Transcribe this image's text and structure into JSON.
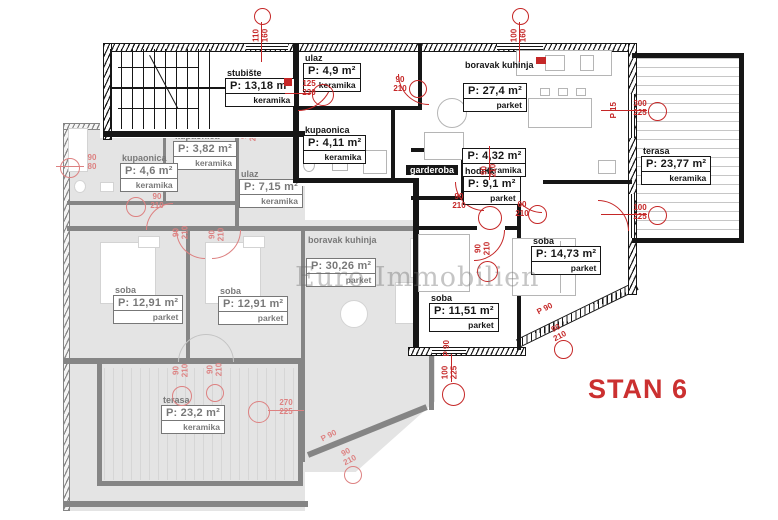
{
  "title": "STAN 6",
  "watermark": "Euro Immobilien",
  "colors": {
    "accent_red": "#c52727",
    "wall": "#161616",
    "faded_gray": "#e2e2e2"
  },
  "rooms": {
    "active": [
      {
        "n": "stubište",
        "a": "P: 13,18 m²",
        "f": "keramika"
      },
      {
        "n": "ulaz",
        "a": "P: 4,9 m²",
        "f": "keramika"
      },
      {
        "n": "kupaonica",
        "a": "P: 4,11 m²",
        "f": "keramika"
      },
      {
        "n": "boravak kuhinja",
        "a": "P: 27,4 m²",
        "f": "parket"
      },
      {
        "n": "garderoba",
        "a": "P: 4,32 m²",
        "f": "keramika"
      },
      {
        "n": "hodnik",
        "a": "P: 9,1 m²",
        "f": "parket"
      },
      {
        "n": "soba",
        "a": "P: 14,73 m²",
        "f": "parket"
      },
      {
        "n": "soba",
        "a": "P: 11,51 m²",
        "f": "parket"
      },
      {
        "n": "terasa",
        "a": "P: 23,77 m²",
        "f": "keramika"
      }
    ],
    "adjacent": [
      {
        "n": "kupaonica",
        "a": "P: 3,82 m²",
        "f": "keramika"
      },
      {
        "n": "kupaonica",
        "a": "P: 4,6 m²",
        "f": "keramika"
      },
      {
        "n": "ulaz",
        "a": "P: 7,15 m²",
        "f": "keramika"
      },
      {
        "n": "boravak kuhinja",
        "a": "P: 30,26 m²",
        "f": "parket"
      },
      {
        "n": "soba",
        "a": "P: 12,91 m²",
        "f": "parket"
      },
      {
        "n": "soba",
        "a": "P: 12,91 m²",
        "f": "parket"
      },
      {
        "n": "terasa",
        "a": "P: 23,2 m²",
        "f": "keramika"
      }
    ]
  },
  "markers": {
    "active": [
      "110\n160",
      "100\n160",
      "300\n225",
      "100\n225",
      "125\n230",
      "90\n210",
      "90\n210",
      "90\n210",
      "60\n210",
      "90\n210",
      "P 90",
      "100\n225",
      "P 90",
      "90\n210",
      "P 15"
    ],
    "adjacent": [
      "90\n80",
      "90\n210",
      "90\n210",
      "90\n210",
      "90\n210",
      "90\n210",
      "90\n210",
      "270\n225",
      "P 90",
      "90\n210"
    ]
  }
}
